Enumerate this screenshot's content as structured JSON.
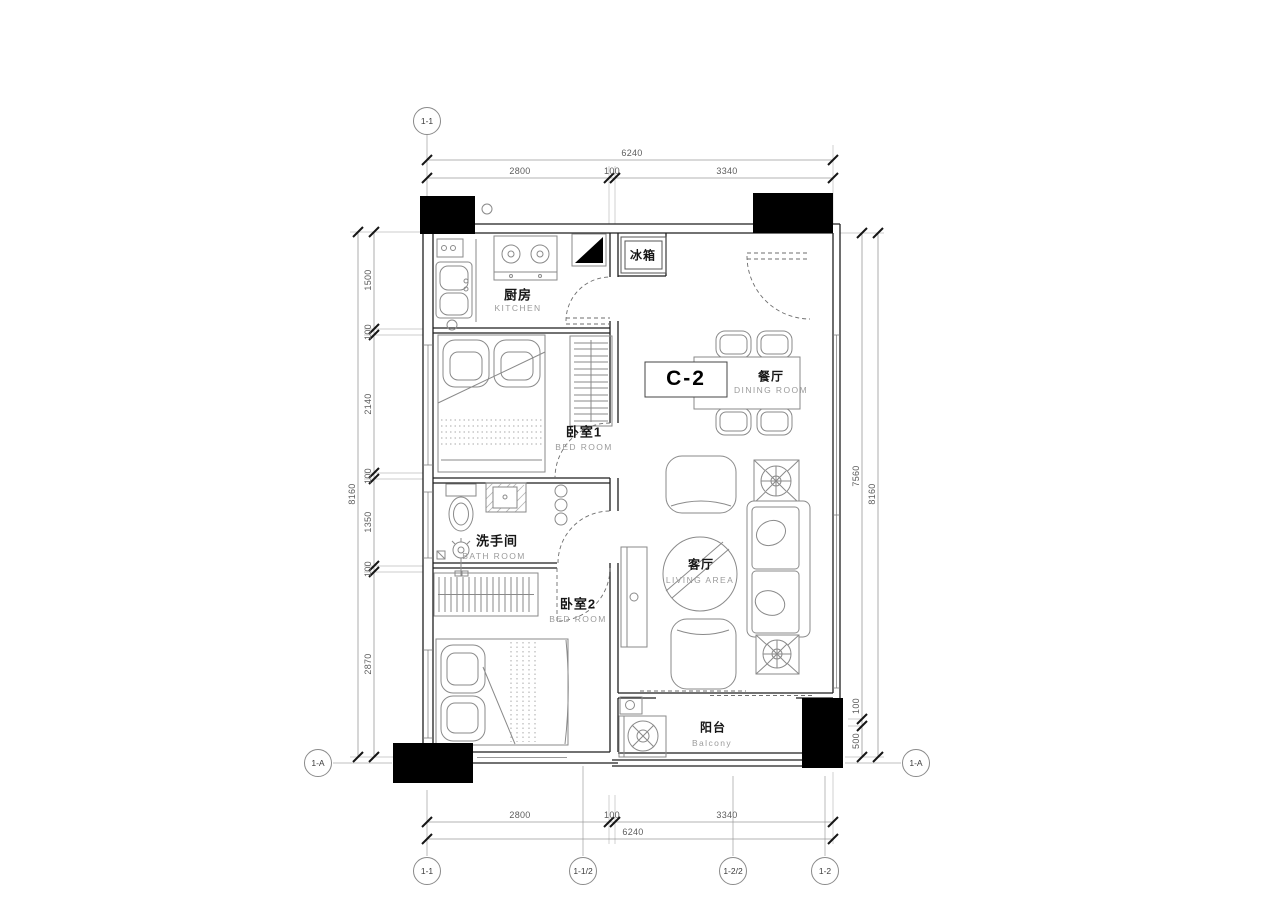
{
  "plan": {
    "unit": "C-2",
    "rooms": {
      "kitchen": {
        "cn": "厨房",
        "en": "KITCHEN"
      },
      "fridge": {
        "cn": "冰箱"
      },
      "dining": {
        "cn": "餐厅",
        "en": "DINING ROOM"
      },
      "bedroom1": {
        "cn": "卧室1",
        "en": "BED ROOM"
      },
      "bathroom": {
        "cn": "洗手间",
        "en": "BATH ROOM"
      },
      "bedroom2": {
        "cn": "卧室2",
        "en": "BED ROOM"
      },
      "living": {
        "cn": "客厅",
        "en": "LIVING AREA"
      },
      "balcony": {
        "cn": "阳台",
        "en": "Balcony"
      }
    },
    "dims": {
      "top": {
        "total": "6240",
        "s1": "2800",
        "s2": "100",
        "s3": "3340"
      },
      "bottom": {
        "total": "6240",
        "s1": "2800",
        "s2": "100",
        "s3": "3340"
      },
      "left": {
        "total": "8160",
        "s1": "1500",
        "s2": "100",
        "s3": "2140",
        "s4": "100",
        "s5": "1350",
        "s6": "100",
        "s7": "2870"
      },
      "right": {
        "total": "8160",
        "s1": "7560",
        "s2": "100",
        "s3": "500"
      }
    },
    "grid": {
      "top1": "1-1",
      "bottom1": "1-1",
      "bottom2": "1-1/2",
      "bottom3": "1-2/2",
      "bottom4": "1-2",
      "left1": "1-A",
      "right1": "1-A"
    }
  }
}
